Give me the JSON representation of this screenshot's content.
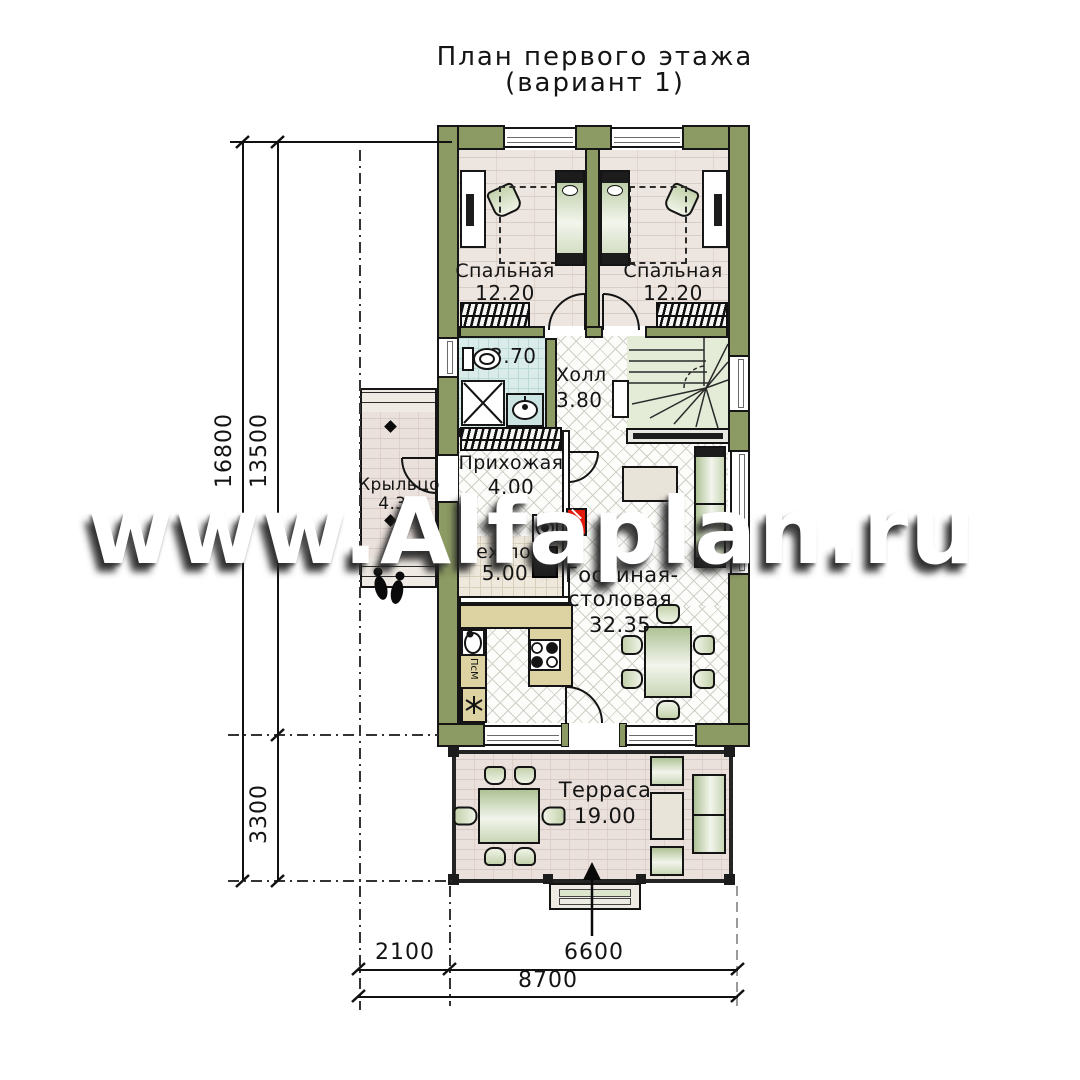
{
  "title": {
    "line1": "План первого этажа",
    "line2": "(вариант 1)"
  },
  "watermark": "www.Alfaplan.ru",
  "rooms": {
    "bedroom1": {
      "name": "Спальная",
      "area": "12.20"
    },
    "bedroom2": {
      "name": "Спальная",
      "area": "12.20"
    },
    "bathroom": {
      "area": "3.70"
    },
    "hall": {
      "name": "Холл",
      "area": "3.80"
    },
    "hallway": {
      "name": "Прихожая",
      "area": "4.00"
    },
    "porch": {
      "name": "Крыльцо",
      "area": "4.30"
    },
    "tech": {
      "name": "Тех.пом",
      "area": "5.00"
    },
    "living": {
      "line1": "Гостиная-",
      "line2": "столовая",
      "area": "32.35"
    },
    "terrace": {
      "name": "Терраса",
      "area": "19.00"
    }
  },
  "kitchen": {
    "dishwasher_label": "ПсМ"
  },
  "dimensions": {
    "v_total": "16800",
    "v_main": "13500",
    "v_terrace": "3300",
    "h_porch": "2100",
    "h_main": "6600",
    "h_total": "8700"
  },
  "colors": {
    "wall": "#8C9A63",
    "stair": "#E4ECD8",
    "counter": "#DCD2A2",
    "boiler_red": "#E21B0C"
  }
}
